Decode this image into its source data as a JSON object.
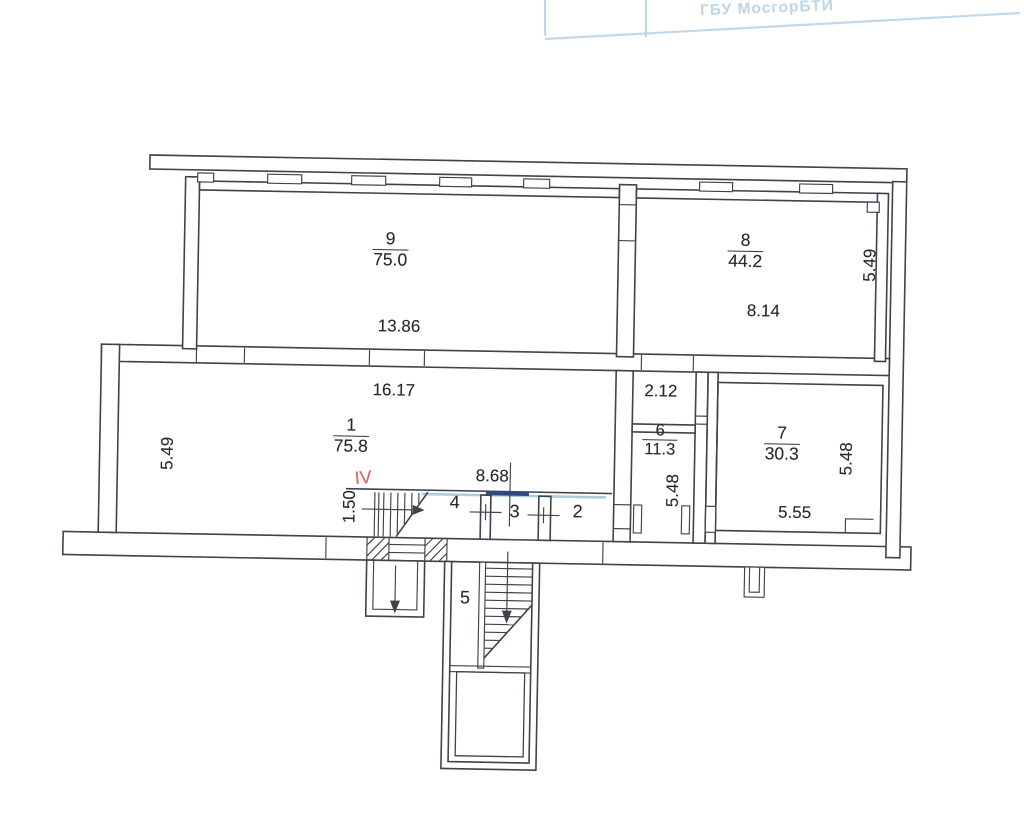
{
  "stamp": {
    "text": "ГБУ МосгорБТИ"
  },
  "plan": {
    "floor_mark": "IV",
    "rooms": {
      "r9": {
        "number": "9",
        "area": "75.0"
      },
      "r8": {
        "number": "8",
        "area": "44.2"
      },
      "r1": {
        "number": "1",
        "area": "75.8"
      },
      "r6": {
        "number": "6",
        "area": "11.3"
      },
      "r7": {
        "number": "7",
        "area": "30.3"
      },
      "r4": {
        "number": "4"
      },
      "r3": {
        "number": "3"
      },
      "r2": {
        "number": "2"
      },
      "r5": {
        "number": "5"
      }
    },
    "dimensions": {
      "room9_bottom": "13.86",
      "room8_bottom": "8.14",
      "room8_right": "5.49",
      "room1_top": "16.17",
      "room1_left": "5.49",
      "stair_width": "1.50",
      "rooms_432_top": "8.68",
      "lobby_top": "2.12",
      "room6_right": "5.48",
      "room7_right": "5.48",
      "room7_bottom": "5.55"
    },
    "colors": {
      "line": "#3f434b",
      "red_mark": "#e4615f",
      "stamp_blue": "#b7d1e6",
      "teal_line": "#a9ced8",
      "navy_segment": "#2c4a86"
    }
  }
}
